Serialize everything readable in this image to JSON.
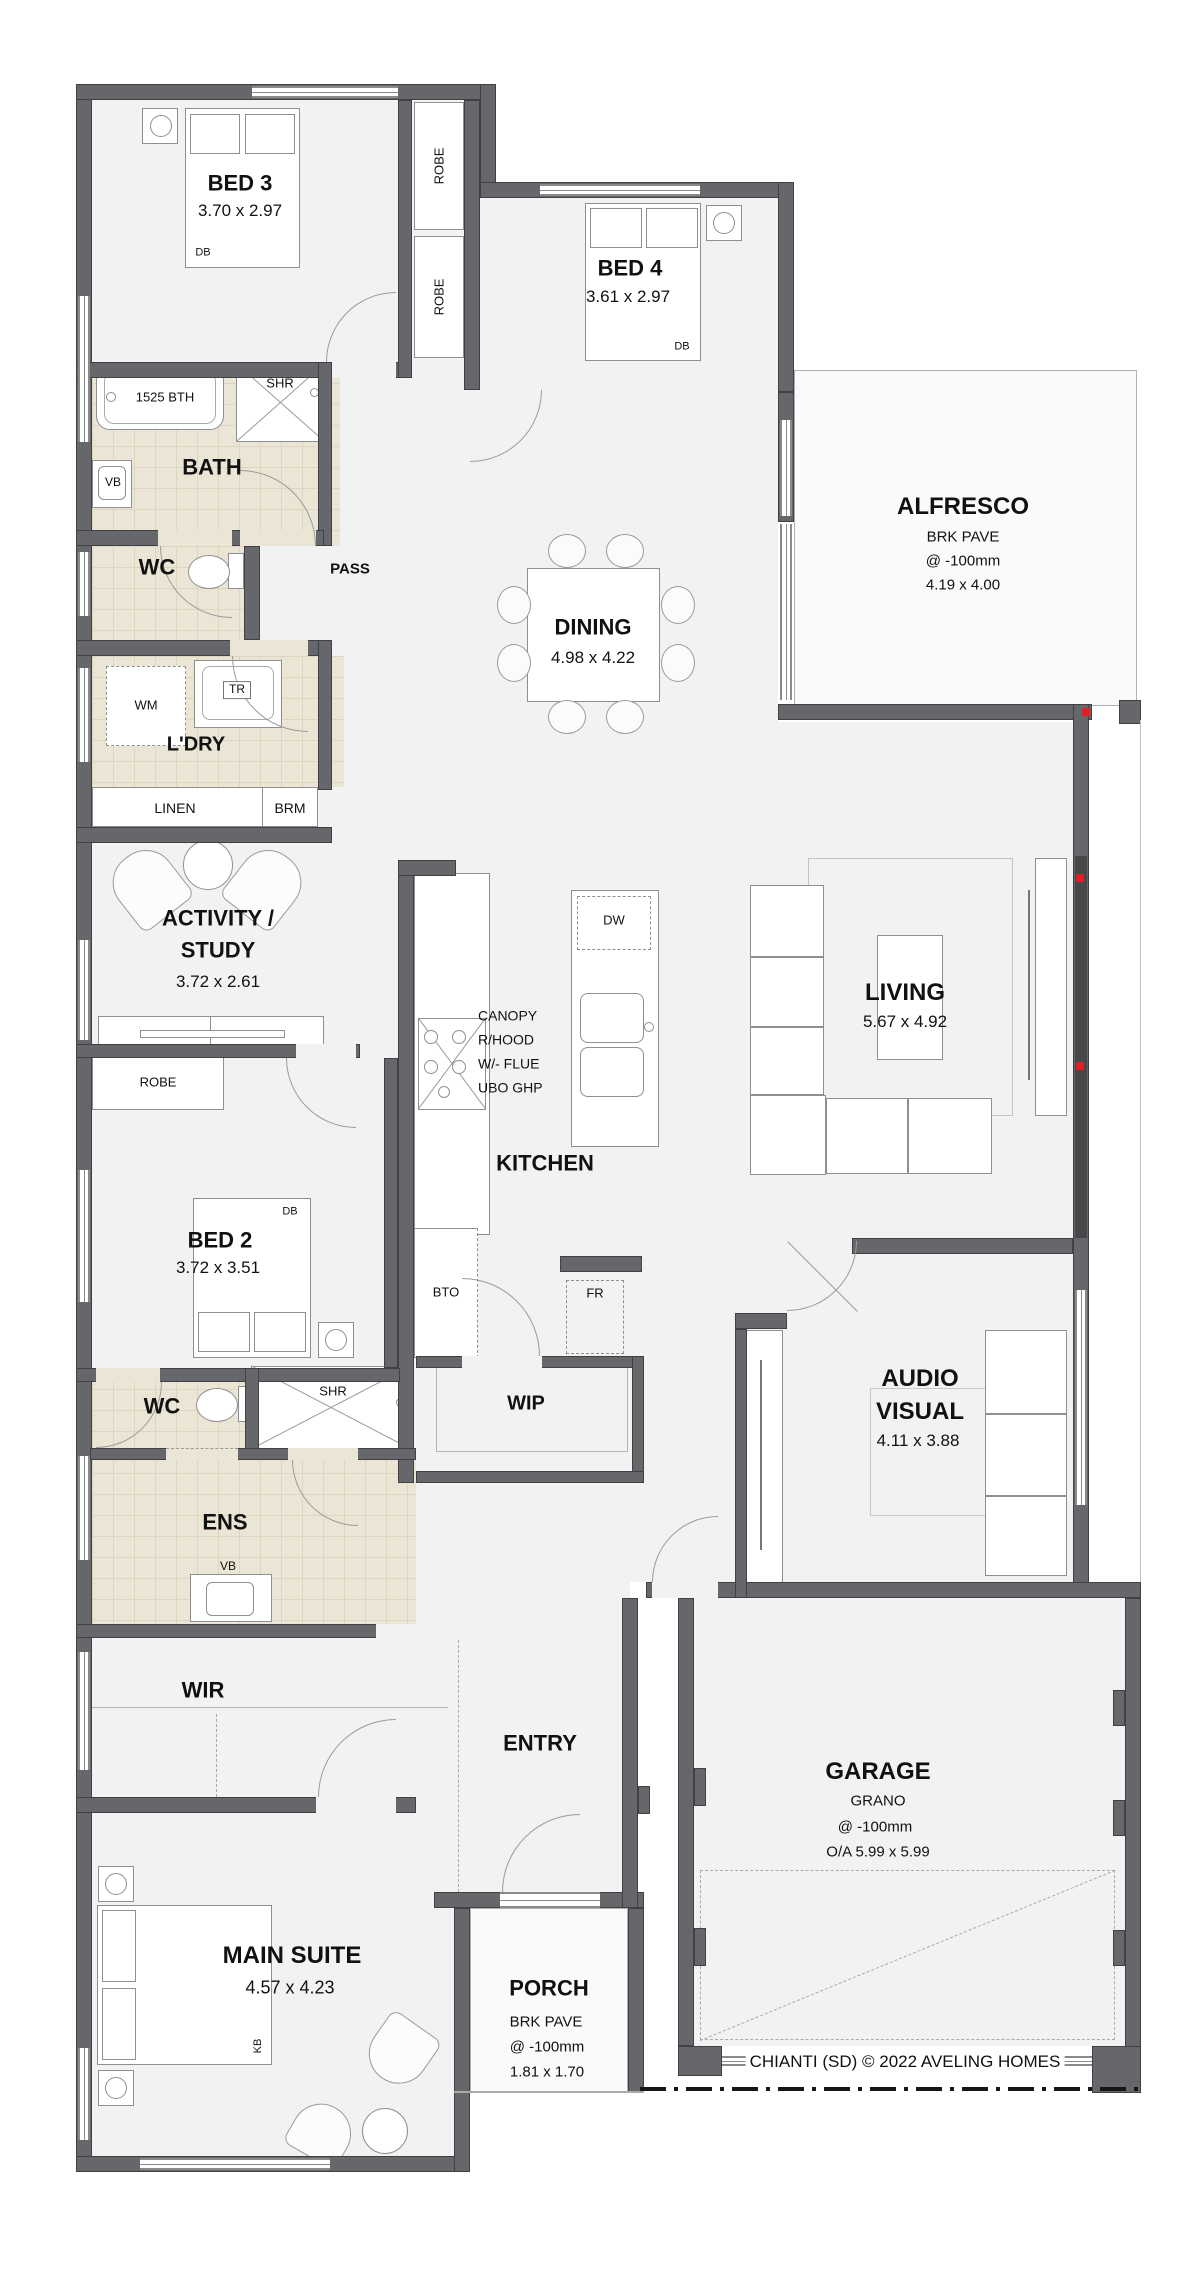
{
  "footer": {
    "copyright": "CHIANTI (SD) © 2022 AVELING HOMES"
  },
  "colors": {
    "wall": "#66676a",
    "wet_floor": "#eae5d4",
    "accent_red": "#e31e24"
  },
  "rooms": {
    "bed3": {
      "name": "BED 3",
      "dims": "3.70 x 2.97"
    },
    "bed4": {
      "name": "BED 4",
      "dims": "3.61 x 2.97"
    },
    "bed2": {
      "name": "BED 2",
      "dims": "3.72 x 3.51"
    },
    "main_suite": {
      "name": "MAIN SUITE",
      "dims": "4.57 x 4.23"
    },
    "activity": {
      "line1": "ACTIVITY /",
      "line2": "STUDY",
      "dims": "3.72 x 2.61"
    },
    "dining": {
      "name": "DINING",
      "dims": "4.98 x 4.22"
    },
    "living": {
      "name": "LIVING",
      "dims": "5.67 x 4.92"
    },
    "kitchen": {
      "name": "KITCHEN"
    },
    "audio_visual": {
      "line1": "AUDIO",
      "line2": "VISUAL",
      "dims": "4.11 x 3.88"
    },
    "alfresco": {
      "name": "ALFRESCO",
      "finish": "BRK PAVE",
      "level": "@ -100mm",
      "dims": "4.19 x 4.00"
    },
    "garage": {
      "name": "GARAGE",
      "finish": "GRANO",
      "level": "@ -100mm",
      "dims": "O/A  5.99 x 5.99"
    },
    "porch": {
      "name": "PORCH",
      "finish": "BRK PAVE",
      "level": "@ -100mm",
      "dims": "1.81 x 1.70"
    },
    "bath": {
      "name": "BATH"
    },
    "ens": {
      "name": "ENS"
    },
    "wc_main": {
      "name": "WC"
    },
    "wc_ens": {
      "name": "WC"
    },
    "laundry": {
      "name": "L'DRY"
    },
    "pass": {
      "name": "PASS"
    },
    "entry": {
      "name": "ENTRY"
    },
    "wip": {
      "name": "WIP"
    },
    "wir": {
      "name": "WIR"
    },
    "linen": {
      "name": "LINEN"
    },
    "broom": {
      "name": "BRM"
    },
    "robe": {
      "name": "ROBE"
    }
  },
  "fixtures": {
    "bath_tub": "1525 BTH",
    "shower": "SHR",
    "vanity": "VB",
    "washing_machine": "WM",
    "trough": "TR",
    "dishwasher": "DW",
    "fridge": "FR",
    "bench_top_oven": "BTO",
    "double_bed": "DB",
    "king_bed": "KB",
    "canopy": {
      "line1": "CANOPY",
      "line2": "R/HOOD",
      "line3": "W/- FLUE",
      "line4": "UBO GHP"
    }
  }
}
